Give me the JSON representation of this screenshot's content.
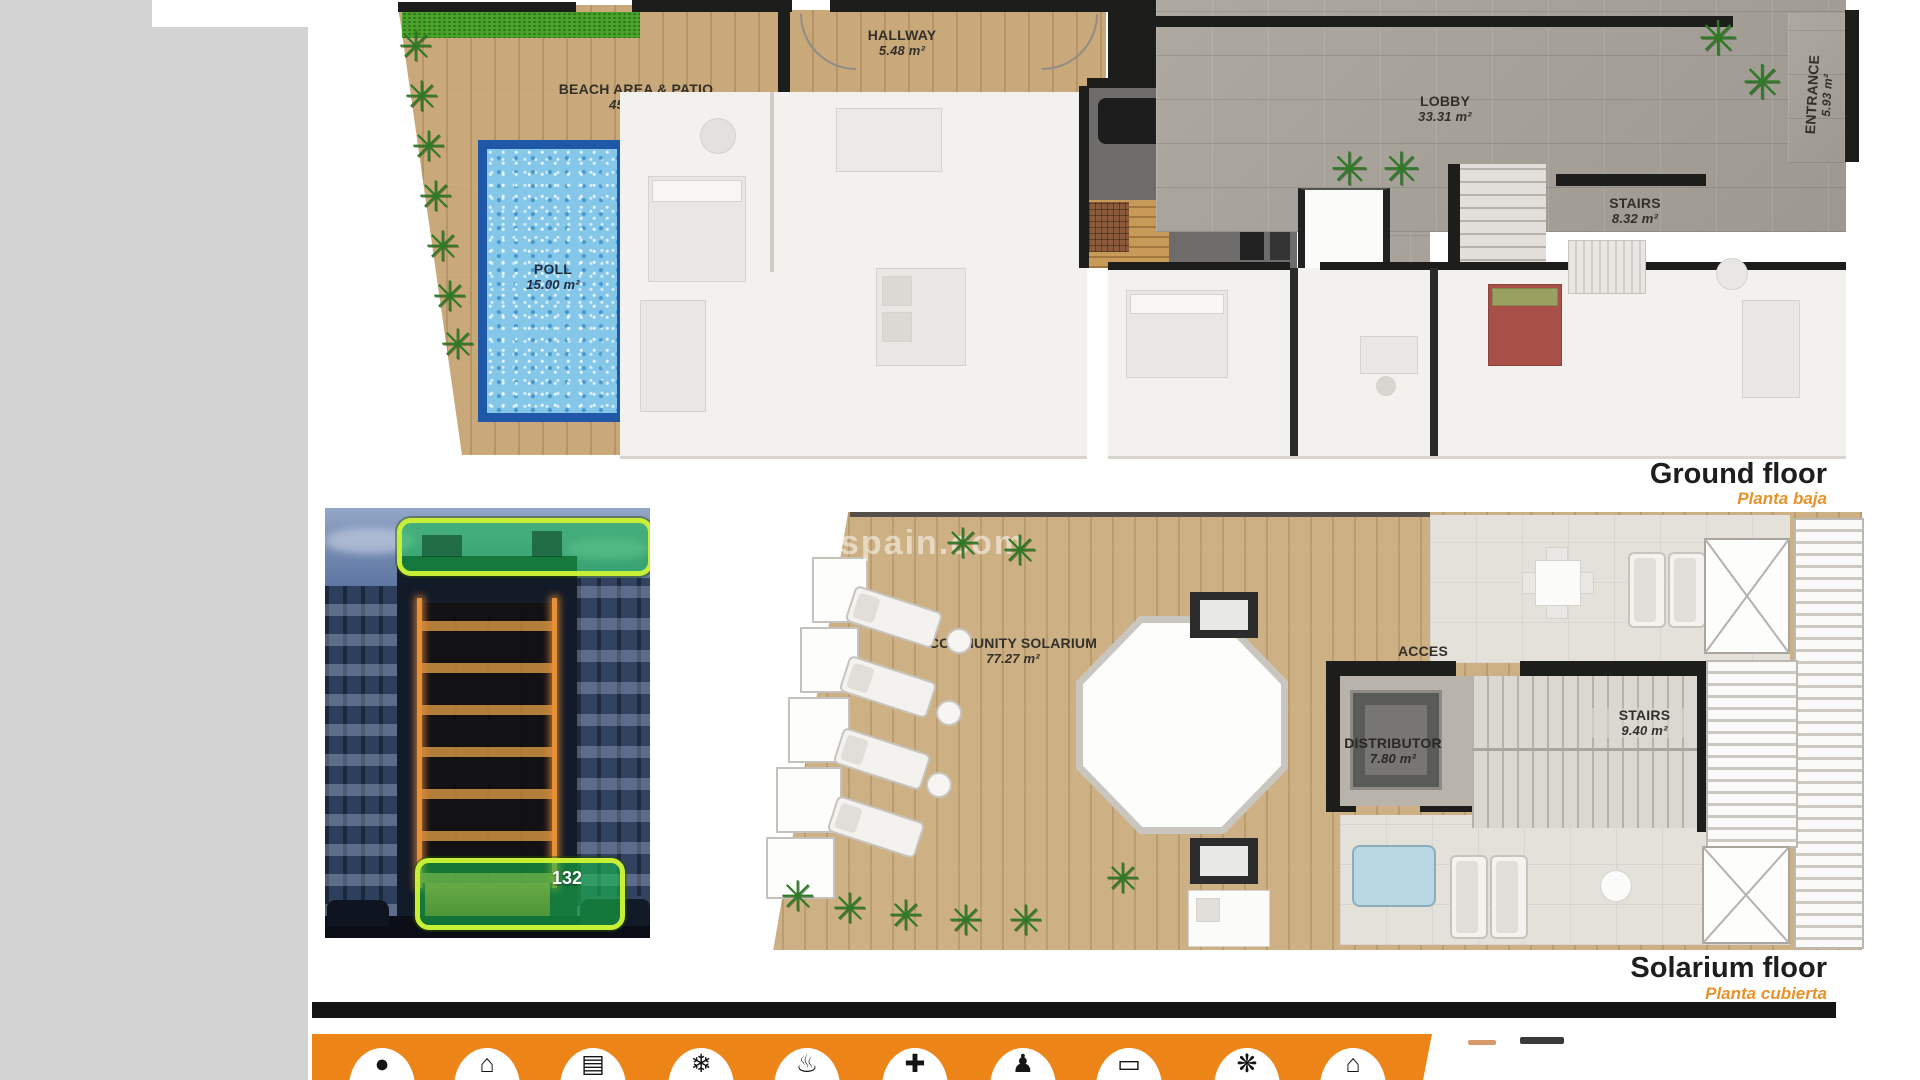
{
  "page": {
    "sidebar_color": "#d3d3d3",
    "background": "#ffffff"
  },
  "ground_floor": {
    "title": "Ground floor",
    "subtitle": "Planta baja",
    "rooms": {
      "beach_patio": {
        "name": "BEACH AREA & PATIO",
        "area": "45.74 m²"
      },
      "pool": {
        "name": "POLL",
        "area": "15.00 m²"
      },
      "hallway": {
        "name": "HALLWAY",
        "area": "5.48 m²"
      },
      "gym_sauna": {
        "name": "GYM & SAUNA",
        "area": "11.00 m²"
      },
      "lobby": {
        "name": "LOBBY",
        "area": "33.31 m²"
      },
      "stairs": {
        "name": "STAIRS",
        "area": "8.32 m²"
      },
      "entrance": {
        "name": "ENTRANCE",
        "area": "5.93 m²"
      }
    }
  },
  "solarium_floor": {
    "title": "Solarium floor",
    "subtitle": "Planta cubierta",
    "watermark": "spain.com",
    "rooms": {
      "community_solarium": {
        "name": "COMMUNITY SOLARIUM",
        "area": "77.27 m²"
      },
      "acces": {
        "name": "ACCES"
      },
      "distributor": {
        "name": "DISTRIBUTOR",
        "area": "7.80 m²"
      },
      "stairs": {
        "name": "STAIRS",
        "area": "9.40 m²"
      }
    }
  },
  "building_photo": {
    "badge": "132"
  },
  "glyphs": {
    "palm": "✳"
  },
  "amenities": {
    "bar_color": "#ec8418",
    "icons": [
      {
        "name": "person",
        "glyph": "●"
      },
      {
        "name": "house",
        "glyph": "⌂"
      },
      {
        "name": "appliance",
        "glyph": "▤"
      },
      {
        "name": "air-conditioning",
        "glyph": "❄"
      },
      {
        "name": "heating",
        "glyph": "♨"
      },
      {
        "name": "health",
        "glyph": "✚"
      },
      {
        "name": "people",
        "glyph": "♟"
      },
      {
        "name": "tv",
        "glyph": "▭"
      },
      {
        "name": "palm-tree",
        "glyph": "❋"
      },
      {
        "name": "home",
        "glyph": "⌂"
      }
    ]
  },
  "colors": {
    "accent_orange": "#e8922a",
    "highlight_green_fill": "#16be4b",
    "highlight_green_border": "#c6ef35",
    "pool_blue": "#85c7e8",
    "wall_black": "#1d1d1b"
  }
}
